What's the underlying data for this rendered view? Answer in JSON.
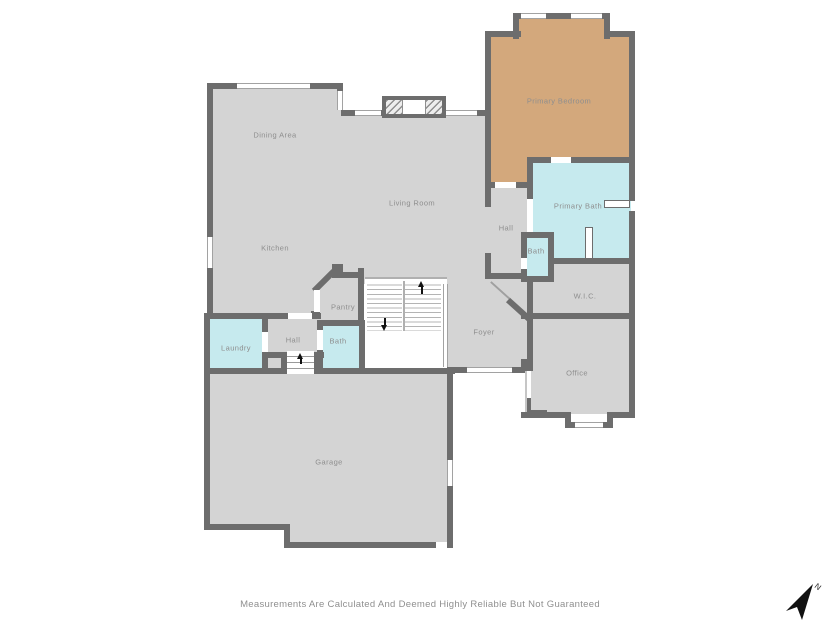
{
  "disclaimer": "Measurements Are Calculated And Deemed Highly Reliable But Not Guaranteed",
  "compass": {
    "label": "N"
  },
  "colors": {
    "wall": "#6d6d6d",
    "floor_gray": "#d4d4d4",
    "floor_cyan": "#c6eaee",
    "floor_tan": "#d3a87c",
    "label_text": "#8e8e8e"
  },
  "rooms": {
    "dining_area": {
      "label": "Dining Area"
    },
    "kitchen": {
      "label": "Kitchen"
    },
    "living_room": {
      "label": "Living Room"
    },
    "primary_bedroom": {
      "label": "Primary Bedroom"
    },
    "primary_bath": {
      "label": "Primary Bath"
    },
    "hall_upper": {
      "label": "Hall"
    },
    "bath_upper": {
      "label": "Bath"
    },
    "wic": {
      "label": "W.I.C."
    },
    "office": {
      "label": "Office"
    },
    "foyer": {
      "label": "Foyer"
    },
    "pantry": {
      "label": "Pantry"
    },
    "laundry": {
      "label": "Laundry"
    },
    "hall_lower": {
      "label": "Hall"
    },
    "bath_lower": {
      "label": "Bath"
    },
    "garage": {
      "label": "Garage"
    }
  }
}
